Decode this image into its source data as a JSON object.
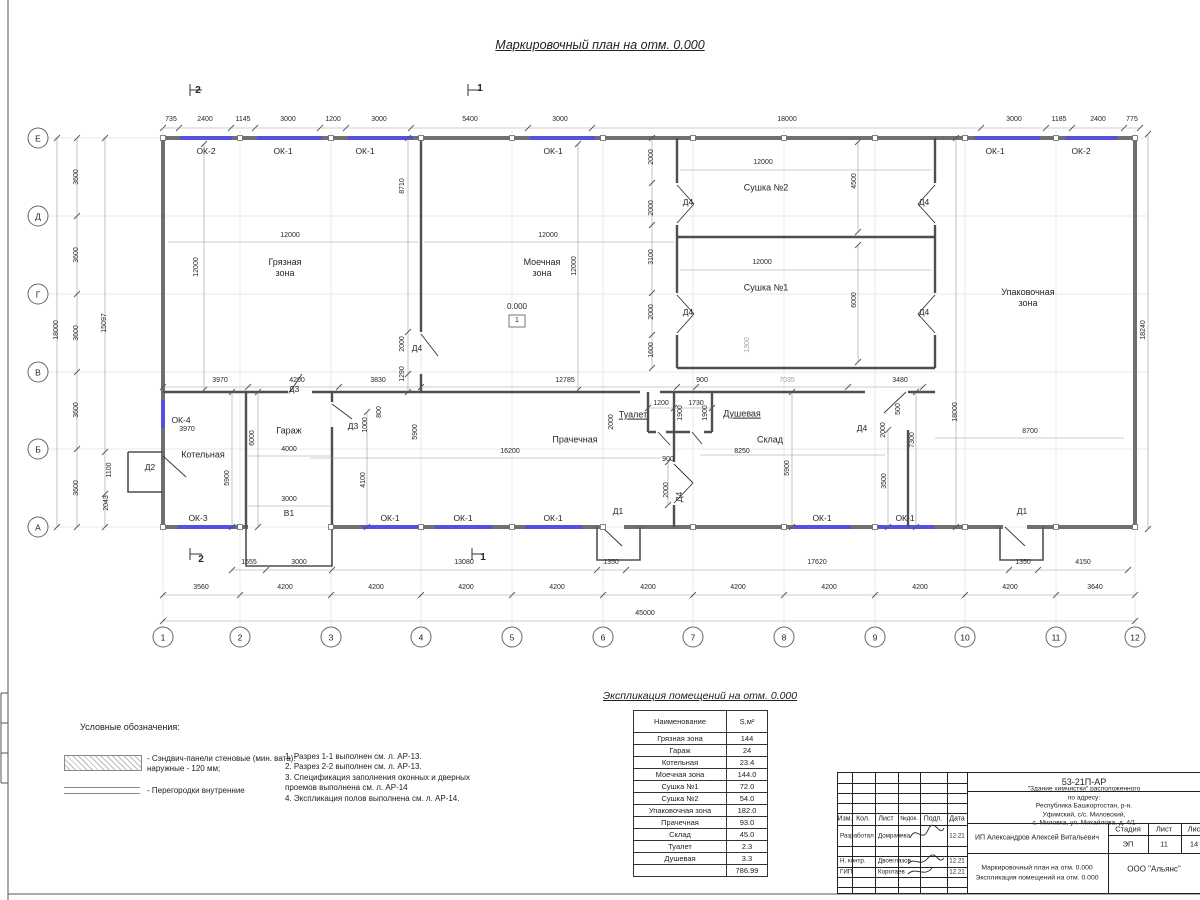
{
  "colors": {
    "window_accent": "#5551e0",
    "wall_outer": "#6f6f6f",
    "wall_inner": "#4f4f4f"
  },
  "page": {
    "title": "Маркировочный план на отм. 0.000"
  },
  "plan": {
    "axis_cols": [
      "1",
      "2",
      "3",
      "4",
      "5",
      "6",
      "7",
      "8",
      "9",
      "10",
      "11",
      "12"
    ],
    "axis_rows": [
      "Е",
      "Д",
      "Г",
      "В",
      "Б",
      "А"
    ],
    "col_xs": [
      163,
      240,
      331,
      421,
      512,
      603,
      693,
      784,
      875,
      965,
      1056,
      1135
    ],
    "row_ys": [
      138,
      216,
      294,
      372,
      449,
      527
    ],
    "col_bubble_y": 637,
    "row_bubble_x": 38,
    "level_value": "0.000",
    "level_tag": "1",
    "chains": [
      {
        "y": 128,
        "xs": [
          163,
          179,
          231,
          255,
          320,
          346,
          411,
          528,
          592,
          981,
          1046,
          1072,
          1124,
          1140
        ]
      },
      {
        "y": 570,
        "xs": [
          232,
          266,
          332,
          597,
          626,
          1009,
          1038,
          1128
        ]
      },
      {
        "y": 595,
        "xs": [
          163,
          240,
          331,
          421,
          512,
          603,
          693,
          784,
          875,
          965,
          1056,
          1135
        ]
      },
      {
        "y": 621,
        "xs": [
          163,
          1135
        ]
      },
      {
        "y": 387,
        "xs": [
          163,
          248,
          339,
          421,
          677,
          696,
          848,
          923
        ]
      },
      {
        "y": 408,
        "xs": [
          648,
          674,
          712
        ]
      },
      {
        "x": 57,
        "ys": [
          138,
          527
        ]
      },
      {
        "x": 77,
        "ys": [
          138,
          216,
          294,
          372,
          449,
          527
        ]
      },
      {
        "x": 105,
        "ys": [
          138,
          452,
          494,
          527
        ]
      },
      {
        "x": 1148,
        "ys": [
          134,
          529
        ]
      },
      {
        "x": 652,
        "ys": [
          138,
          183,
          225,
          293,
          335,
          368
        ]
      },
      {
        "x": 408,
        "ys": [
          138,
          332,
          374,
          392
        ]
      },
      {
        "x": 204,
        "ys": [
          144,
          390
        ]
      },
      {
        "x": 578,
        "ys": [
          144,
          390
        ]
      },
      {
        "x": 858,
        "ys": [
          142,
          232
        ]
      },
      {
        "x": 858,
        "ys": [
          245,
          362
        ]
      },
      {
        "x": 232,
        "ys": [
          392,
          527
        ]
      },
      {
        "x": 258,
        "ys": [
          392,
          527
        ]
      },
      {
        "x": 367,
        "ys": [
          412,
          527
        ]
      },
      {
        "x": 792,
        "ys": [
          392,
          527
        ]
      },
      {
        "x": 956,
        "ys": [
          138,
          527
        ]
      },
      {
        "x": 916,
        "ys": [
          392,
          527
        ]
      },
      {
        "x": 888,
        "ys": [
          430,
          527
        ]
      },
      {
        "x": 668,
        "ys": [
          462,
          505
        ]
      }
    ],
    "lines": [
      [
        168,
        242,
        418,
        242
      ],
      [
        424,
        242,
        674,
        242
      ],
      [
        680,
        170,
        932,
        170
      ],
      [
        680,
        270,
        932,
        270
      ],
      [
        310,
        458,
        660,
        458
      ],
      [
        700,
        455,
        885,
        455
      ],
      [
        935,
        438,
        1124,
        438
      ],
      [
        248,
        456,
        330,
        456
      ],
      [
        248,
        506,
        330,
        506
      ]
    ],
    "texts": [
      {
        "t": "735",
        "x": 171,
        "y": 120
      },
      {
        "t": "2400",
        "x": 205,
        "y": 120
      },
      {
        "t": "1145",
        "x": 243,
        "y": 120
      },
      {
        "t": "3000",
        "x": 288,
        "y": 120
      },
      {
        "t": "1200",
        "x": 333,
        "y": 120
      },
      {
        "t": "3000",
        "x": 379,
        "y": 120
      },
      {
        "t": "5400",
        "x": 470,
        "y": 120
      },
      {
        "t": "3000",
        "x": 560,
        "y": 120
      },
      {
        "t": "18000",
        "x": 787,
        "y": 120
      },
      {
        "t": "3000",
        "x": 1014,
        "y": 120
      },
      {
        "t": "1185",
        "x": 1059,
        "y": 120
      },
      {
        "t": "2400",
        "x": 1098,
        "y": 120
      },
      {
        "t": "775",
        "x": 1132,
        "y": 120
      },
      {
        "t": "1555",
        "x": 249,
        "y": 563
      },
      {
        "t": "3000",
        "x": 299,
        "y": 563
      },
      {
        "t": "13080",
        "x": 464,
        "y": 563
      },
      {
        "t": "1350",
        "x": 611,
        "y": 563
      },
      {
        "t": "17620",
        "x": 817,
        "y": 563
      },
      {
        "t": "1350",
        "x": 1023,
        "y": 563
      },
      {
        "t": "4150",
        "x": 1083,
        "y": 563
      },
      {
        "t": "3560",
        "x": 201,
        "y": 588
      },
      {
        "t": "4200",
        "x": 285,
        "y": 588
      },
      {
        "t": "4200",
        "x": 376,
        "y": 588
      },
      {
        "t": "4200",
        "x": 466,
        "y": 588
      },
      {
        "t": "4200",
        "x": 557,
        "y": 588
      },
      {
        "t": "4200",
        "x": 648,
        "y": 588
      },
      {
        "t": "4200",
        "x": 738,
        "y": 588
      },
      {
        "t": "4200",
        "x": 829,
        "y": 588
      },
      {
        "t": "4200",
        "x": 920,
        "y": 588
      },
      {
        "t": "4200",
        "x": 1010,
        "y": 588
      },
      {
        "t": "3640",
        "x": 1095,
        "y": 588
      },
      {
        "t": "45000",
        "x": 645,
        "y": 614
      },
      {
        "t": "18000",
        "x": 57,
        "y": 330,
        "r": 1
      },
      {
        "t": "3600",
        "x": 77,
        "y": 177,
        "r": 1
      },
      {
        "t": "3600",
        "x": 77,
        "y": 255,
        "r": 1
      },
      {
        "t": "3600",
        "x": 77,
        "y": 333,
        "r": 1
      },
      {
        "t": "3600",
        "x": 77,
        "y": 410,
        "r": 1
      },
      {
        "t": "3600",
        "x": 77,
        "y": 488,
        "r": 1
      },
      {
        "t": "15097",
        "x": 105,
        "y": 323,
        "r": 1
      },
      {
        "t": "1100",
        "x": 110,
        "y": 470,
        "r": 1
      },
      {
        "t": "2043",
        "x": 107,
        "y": 503,
        "r": 1
      },
      {
        "t": "18240",
        "x": 1144,
        "y": 330,
        "r": 1
      },
      {
        "t": "12000",
        "x": 290,
        "y": 236
      },
      {
        "t": "12000",
        "x": 548,
        "y": 236
      },
      {
        "t": "12785",
        "x": 565,
        "y": 381
      },
      {
        "t": "3970",
        "x": 220,
        "y": 381
      },
      {
        "t": "4200",
        "x": 297,
        "y": 381
      },
      {
        "t": "3830",
        "x": 378,
        "y": 381
      },
      {
        "t": "12000",
        "x": 763,
        "y": 163
      },
      {
        "t": "12000",
        "x": 762,
        "y": 263
      },
      {
        "t": "900",
        "x": 702,
        "y": 381
      },
      {
        "t": "3480",
        "x": 900,
        "y": 381
      },
      {
        "t": "7035",
        "x": 787,
        "y": 381,
        "c": "dg"
      },
      {
        "t": "8700",
        "x": 1030,
        "y": 432
      },
      {
        "t": "3970",
        "x": 187,
        "y": 430
      },
      {
        "t": "4000",
        "x": 289,
        "y": 450
      },
      {
        "t": "3000",
        "x": 289,
        "y": 500
      },
      {
        "t": "16200",
        "x": 510,
        "y": 452
      },
      {
        "t": "1200",
        "x": 661,
        "y": 404
      },
      {
        "t": "1730",
        "x": 696,
        "y": 404
      },
      {
        "t": "900",
        "x": 668,
        "y": 460
      },
      {
        "t": "8250",
        "x": 742,
        "y": 452
      },
      {
        "t": "1300",
        "x": 748,
        "y": 345,
        "r": 1,
        "c": "dg"
      },
      {
        "t": "12000",
        "x": 197,
        "y": 267,
        "r": 1
      },
      {
        "t": "8710",
        "x": 403,
        "y": 186,
        "r": 1
      },
      {
        "t": "2000",
        "x": 403,
        "y": 344,
        "r": 1
      },
      {
        "t": "1290",
        "x": 403,
        "y": 374,
        "r": 1
      },
      {
        "t": "12000",
        "x": 575,
        "y": 266,
        "r": 1
      },
      {
        "t": "2000",
        "x": 652,
        "y": 157,
        "r": 1
      },
      {
        "t": "2000",
        "x": 652,
        "y": 208,
        "r": 1
      },
      {
        "t": "3100",
        "x": 652,
        "y": 257,
        "r": 1
      },
      {
        "t": "2000",
        "x": 652,
        "y": 312,
        "r": 1
      },
      {
        "t": "1600",
        "x": 652,
        "y": 350,
        "r": 1
      },
      {
        "t": "4500",
        "x": 855,
        "y": 181,
        "r": 1
      },
      {
        "t": "6000",
        "x": 855,
        "y": 300,
        "r": 1
      },
      {
        "t": "18000",
        "x": 956,
        "y": 412,
        "r": 1
      },
      {
        "t": "7300",
        "x": 913,
        "y": 440,
        "r": 1
      },
      {
        "t": "3500",
        "x": 885,
        "y": 481,
        "r": 1
      },
      {
        "t": "500",
        "x": 899,
        "y": 409,
        "r": 1
      },
      {
        "t": "2000",
        "x": 884,
        "y": 430,
        "r": 1
      },
      {
        "t": "5900",
        "x": 788,
        "y": 468,
        "r": 1
      },
      {
        "t": "2000",
        "x": 612,
        "y": 422,
        "r": 1
      },
      {
        "t": "1900",
        "x": 681,
        "y": 413,
        "r": 1
      },
      {
        "t": "1900",
        "x": 706,
        "y": 413,
        "r": 1
      },
      {
        "t": "2000",
        "x": 667,
        "y": 490,
        "r": 1
      },
      {
        "t": "6000",
        "x": 253,
        "y": 438,
        "r": 1
      },
      {
        "t": "5900",
        "x": 228,
        "y": 478,
        "r": 1
      },
      {
        "t": "4100",
        "x": 364,
        "y": 480,
        "r": 1
      },
      {
        "t": "5900",
        "x": 416,
        "y": 432,
        "r": 1
      },
      {
        "t": "800",
        "x": 380,
        "y": 412,
        "r": 1
      },
      {
        "t": "1000",
        "x": 366,
        "y": 425,
        "r": 1
      },
      {
        "t": "ОК-2",
        "x": 206,
        "y": 151,
        "c": "op"
      },
      {
        "t": "ОК-1",
        "x": 283,
        "y": 151,
        "c": "op"
      },
      {
        "t": "ОК-1",
        "x": 365,
        "y": 151,
        "c": "op"
      },
      {
        "t": "ОК-1",
        "x": 553,
        "y": 151,
        "c": "op"
      },
      {
        "t": "ОК-1",
        "x": 995,
        "y": 151,
        "c": "op"
      },
      {
        "t": "ОК-2",
        "x": 1081,
        "y": 151,
        "c": "op"
      },
      {
        "t": "ОК-4",
        "x": 181,
        "y": 420,
        "c": "op"
      },
      {
        "t": "ОК-3",
        "x": 198,
        "y": 518,
        "c": "op"
      },
      {
        "t": "ОК-1",
        "x": 390,
        "y": 518,
        "c": "op"
      },
      {
        "t": "ОК-1",
        "x": 463,
        "y": 518,
        "c": "op"
      },
      {
        "t": "ОК-1",
        "x": 553,
        "y": 518,
        "c": "op"
      },
      {
        "t": "ОК-1",
        "x": 822,
        "y": 518,
        "c": "op"
      },
      {
        "t": "ОК-1",
        "x": 905,
        "y": 518,
        "c": "op"
      },
      {
        "t": "Д4",
        "x": 417,
        "y": 348,
        "c": "op"
      },
      {
        "t": "Д4",
        "x": 688,
        "y": 202,
        "c": "op"
      },
      {
        "t": "Д4",
        "x": 924,
        "y": 202,
        "c": "op"
      },
      {
        "t": "Д4",
        "x": 688,
        "y": 312,
        "c": "op"
      },
      {
        "t": "Д4",
        "x": 924,
        "y": 312,
        "c": "op"
      },
      {
        "t": "Д4",
        "x": 862,
        "y": 428,
        "c": "op"
      },
      {
        "t": "Д4",
        "x": 679,
        "y": 497,
        "r": 1,
        "c": "op"
      },
      {
        "t": "Д3",
        "x": 294,
        "y": 389,
        "c": "op"
      },
      {
        "t": "Д3",
        "x": 353,
        "y": 426,
        "c": "op"
      },
      {
        "t": "Д2",
        "x": 150,
        "y": 467,
        "c": "op"
      },
      {
        "t": "Д1",
        "x": 618,
        "y": 511,
        "c": "op"
      },
      {
        "t": "Д1",
        "x": 1022,
        "y": 511,
        "c": "op"
      },
      {
        "t": "В1",
        "x": 289,
        "y": 513,
        "c": "op"
      },
      {
        "t": "Грязная\nзона",
        "x": 285,
        "y": 268,
        "c": "room"
      },
      {
        "t": "Моечная\nзона",
        "x": 542,
        "y": 268,
        "c": "room"
      },
      {
        "t": "Сушка №2",
        "x": 766,
        "y": 188,
        "c": "room"
      },
      {
        "t": "Сушка №1",
        "x": 766,
        "y": 288,
        "c": "room"
      },
      {
        "t": "Упаковочная\nзона",
        "x": 1028,
        "y": 298,
        "c": "room"
      },
      {
        "t": "Котельная",
        "x": 203,
        "y": 455,
        "c": "room"
      },
      {
        "t": "Гараж",
        "x": 289,
        "y": 431,
        "c": "room"
      },
      {
        "t": "Прачечная",
        "x": 575,
        "y": 440,
        "c": "room"
      },
      {
        "t": "Туалет",
        "x": 633,
        "y": 415,
        "c": "room u"
      },
      {
        "t": "Душевая",
        "x": 742,
        "y": 414,
        "c": "room u"
      },
      {
        "t": "Склад",
        "x": 770,
        "y": 440,
        "c": "room"
      },
      {
        "t": "0.000",
        "x": 517,
        "y": 307,
        "c": "lvl"
      },
      {
        "t": "2",
        "x": 198,
        "y": 91,
        "c": "sec"
      },
      {
        "t": "1",
        "x": 480,
        "y": 89,
        "c": "sec"
      },
      {
        "t": "2",
        "x": 201,
        "y": 560,
        "c": "sec"
      },
      {
        "t": "1",
        "x": 483,
        "y": 558,
        "c": "sec"
      }
    ]
  },
  "legend": {
    "title": "Условные обозначения:",
    "items": [
      {
        "text": "- Сэндвич-панели стеновые (мин. вата):\nнаружные - 120 мм;"
      },
      {
        "text": "- Перегородки внутренние"
      }
    ]
  },
  "notes": {
    "lines": [
      "1. Разрез 1-1 выполнен см. л. АР-13.",
      "2. Разрез 2-2 выполнен см. л. АР-13.",
      "3. Спецификация заполнения оконных и дверных",
      "проемов выполнена см. л. АР-14",
      "4. Экспликация полов выполнена см. л. АР-14."
    ]
  },
  "schedule": {
    "title": "Экспликация помещений на отм. 0.000",
    "col_name": "Наименование",
    "col_area": "S,м²",
    "rows": [
      {
        "name": "Грязная зона",
        "area": "144"
      },
      {
        "name": "Гараж",
        "area": "24"
      },
      {
        "name": "Котельная",
        "area": "23.4"
      },
      {
        "name": "Моечная зона",
        "area": "144.0"
      },
      {
        "name": "Сушка №1",
        "area": "72.0"
      },
      {
        "name": "Сушка №2",
        "area": "54.0"
      },
      {
        "name": "Упаковочная зона",
        "area": "182.0"
      },
      {
        "name": "Прачечная",
        "area": "93.0"
      },
      {
        "name": "Склад",
        "area": "45.0"
      },
      {
        "name": "Туалет",
        "area": "2.3"
      },
      {
        "name": "Душевая",
        "area": "3.3"
      }
    ],
    "total": "786.99"
  },
  "titleblock": {
    "doc_code": "53-21П-АР",
    "address_lines": "\"Здание химчистки\" расположенного по адресу:\nРеспублика Башкортостан, р-н. Уфимский, с/с. Миловский,\nс. Миловка, ул. Михайлова, д. 4/1",
    "col_izm": "Изм.",
    "col_kol": "Кол.",
    "col_list": "Лист",
    "col_ndok": "№док.",
    "col_podp": "Подп.",
    "col_data": "Дата",
    "row1_role": "Разработал",
    "row1_name": "Домрачева",
    "row1_date": "12.21",
    "row2_role": "Н. контр.",
    "row2_name": "Двоеглазов",
    "row2_date": "12.21",
    "row3_role": "ГИП",
    "row3_name": "Коротаев",
    "row3_date": "12.21",
    "client": "ИП Александров Алексей Витальевич",
    "stage_label": "Стадия",
    "sheet_label": "Лист",
    "sheets_label": "Лис",
    "stage": "ЭП",
    "sheet": "11",
    "sheets": "14",
    "drawing_name_line1": "Маркировочный план на отм. 0.000",
    "drawing_name_line2": "Экспликация помещений на отм. 0.000",
    "company": "ООО \"Альянс\""
  }
}
